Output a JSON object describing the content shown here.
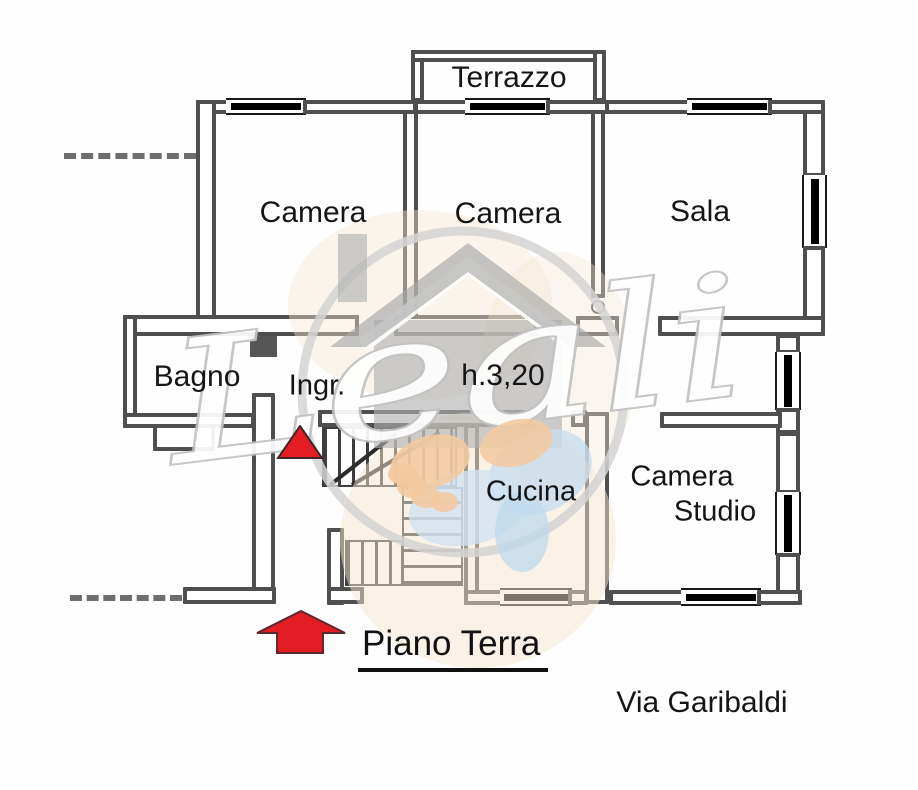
{
  "plan": {
    "floor_title": "Piano Terra",
    "street": "Via Garibaldi",
    "ceiling_height": "h.3,20",
    "rooms": {
      "terrazzo": "Terrazzo",
      "camera_1": "Camera",
      "camera_2": "Camera",
      "sala": "Sala",
      "bagno": "Bagno",
      "ingresso": "Ingr.",
      "cucina": "Cucina",
      "camera_studio": [
        "Camera",
        "Studio"
      ]
    }
  },
  "watermark": {
    "brand": "Leali",
    "icons": [
      "house-icon",
      "handshake-icon",
      "ring-icon"
    ]
  },
  "markers": {
    "entrance_arrow": "up-block-arrow",
    "ingresso_marker": "up-triangle"
  },
  "colors": {
    "arrow_red": "#e41d25",
    "wall": "#4f4f4f",
    "window_bar": "#000000",
    "watermark_gray": "#b0b0b0",
    "watermark_peach": "#f3c9a0",
    "watermark_blue": "#c6dcee",
    "ring_gray": "#d4d4d4"
  }
}
